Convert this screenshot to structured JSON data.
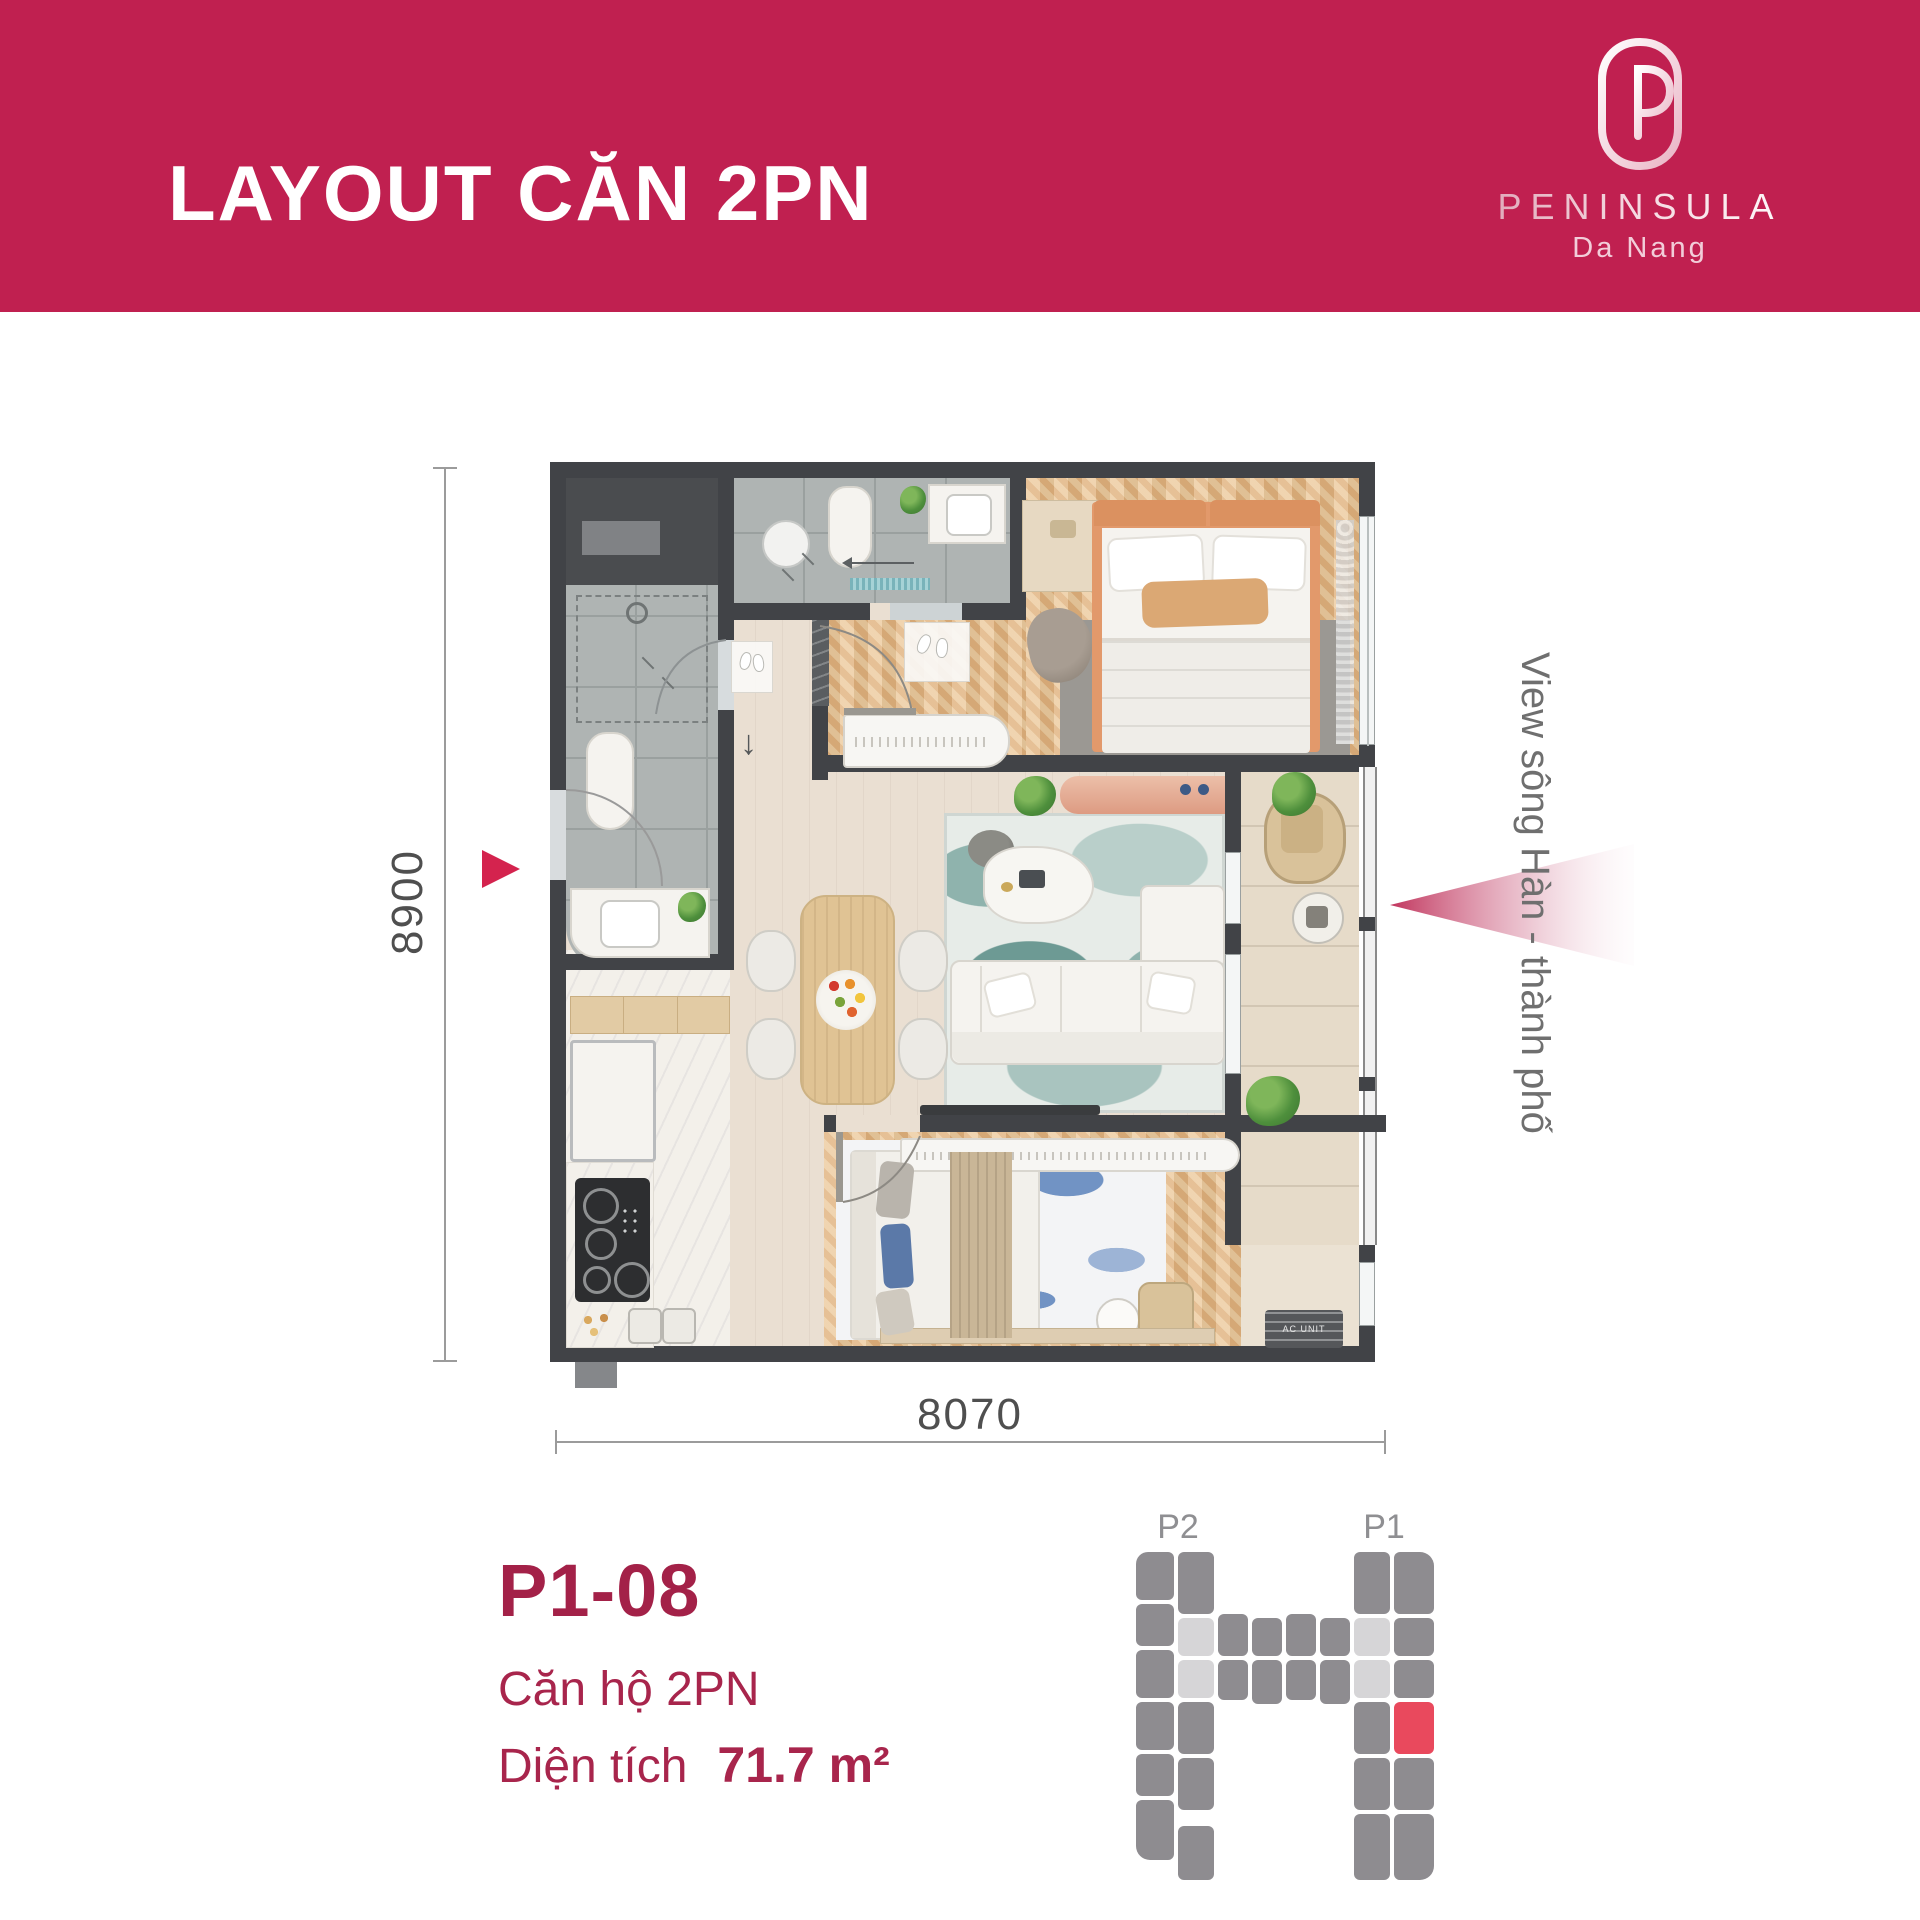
{
  "header": {
    "title": "LAYOUT CĂN 2PN",
    "bg_color": "#C02050"
  },
  "logo": {
    "name": "PENINSULA",
    "subtitle": "Da Nang",
    "mark": "P-monogram"
  },
  "plan": {
    "dim_height": "8900",
    "dim_width": "8070",
    "view_label": "View sông Hàn - thành phố",
    "entry_symbol": "↓",
    "ac_label": "AC UNIT",
    "accent_arrow_color": "#D4234E"
  },
  "unit": {
    "code": "P1-08",
    "type": "Căn hộ 2PN",
    "area_label": "Diện tích",
    "area_value": "71.7 m²"
  },
  "keyplan": {
    "labels": [
      "P2",
      "P1"
    ],
    "colors": {
      "g": "#8E8C90",
      "l": "#D6D5D7",
      "r": "#E9495D"
    },
    "blocks": [
      {
        "x": 8,
        "y": 0,
        "w": 38,
        "h": 48,
        "c": "g",
        "r": "12px 6px 6px 6px"
      },
      {
        "x": 8,
        "y": 52,
        "w": 38,
        "h": 42,
        "c": "g"
      },
      {
        "x": 8,
        "y": 98,
        "w": 38,
        "h": 48,
        "c": "g"
      },
      {
        "x": 8,
        "y": 150,
        "w": 38,
        "h": 48,
        "c": "g"
      },
      {
        "x": 8,
        "y": 202,
        "w": 38,
        "h": 42,
        "c": "g"
      },
      {
        "x": 8,
        "y": 248,
        "w": 38,
        "h": 60,
        "c": "g",
        "r": "6px 6px 6px 14px"
      },
      {
        "x": 50,
        "y": 0,
        "w": 36,
        "h": 62,
        "c": "g"
      },
      {
        "x": 50,
        "y": 66,
        "w": 36,
        "h": 38,
        "c": "l"
      },
      {
        "x": 50,
        "y": 108,
        "w": 36,
        "h": 38,
        "c": "l"
      },
      {
        "x": 50,
        "y": 150,
        "w": 36,
        "h": 52,
        "c": "g"
      },
      {
        "x": 50,
        "y": 206,
        "w": 36,
        "h": 52,
        "c": "g"
      },
      {
        "x": 50,
        "y": 274,
        "w": 36,
        "h": 54,
        "c": "g"
      },
      {
        "x": 90,
        "y": 62,
        "w": 30,
        "h": 42,
        "c": "g"
      },
      {
        "x": 124,
        "y": 66,
        "w": 30,
        "h": 38,
        "c": "g"
      },
      {
        "x": 158,
        "y": 62,
        "w": 30,
        "h": 42,
        "c": "g"
      },
      {
        "x": 192,
        "y": 66,
        "w": 30,
        "h": 38,
        "c": "g"
      },
      {
        "x": 90,
        "y": 108,
        "w": 30,
        "h": 40,
        "c": "g"
      },
      {
        "x": 124,
        "y": 108,
        "w": 30,
        "h": 44,
        "c": "g"
      },
      {
        "x": 158,
        "y": 108,
        "w": 30,
        "h": 40,
        "c": "g"
      },
      {
        "x": 192,
        "y": 108,
        "w": 30,
        "h": 44,
        "c": "g"
      },
      {
        "x": 226,
        "y": 0,
        "w": 36,
        "h": 62,
        "c": "g"
      },
      {
        "x": 226,
        "y": 66,
        "w": 36,
        "h": 38,
        "c": "l"
      },
      {
        "x": 226,
        "y": 108,
        "w": 36,
        "h": 38,
        "c": "l"
      },
      {
        "x": 226,
        "y": 150,
        "w": 36,
        "h": 52,
        "c": "g"
      },
      {
        "x": 226,
        "y": 206,
        "w": 36,
        "h": 52,
        "c": "g"
      },
      {
        "x": 226,
        "y": 262,
        "w": 36,
        "h": 66,
        "c": "g"
      },
      {
        "x": 266,
        "y": 0,
        "w": 40,
        "h": 62,
        "c": "g",
        "r": "6px 14px 6px 6px"
      },
      {
        "x": 266,
        "y": 66,
        "w": 40,
        "h": 38,
        "c": "g"
      },
      {
        "x": 266,
        "y": 108,
        "w": 40,
        "h": 38,
        "c": "g"
      },
      {
        "x": 266,
        "y": 150,
        "w": 40,
        "h": 52,
        "c": "r"
      },
      {
        "x": 266,
        "y": 206,
        "w": 40,
        "h": 52,
        "c": "g"
      },
      {
        "x": 266,
        "y": 262,
        "w": 40,
        "h": 66,
        "c": "g",
        "r": "6px 6px 14px 6px"
      }
    ]
  }
}
